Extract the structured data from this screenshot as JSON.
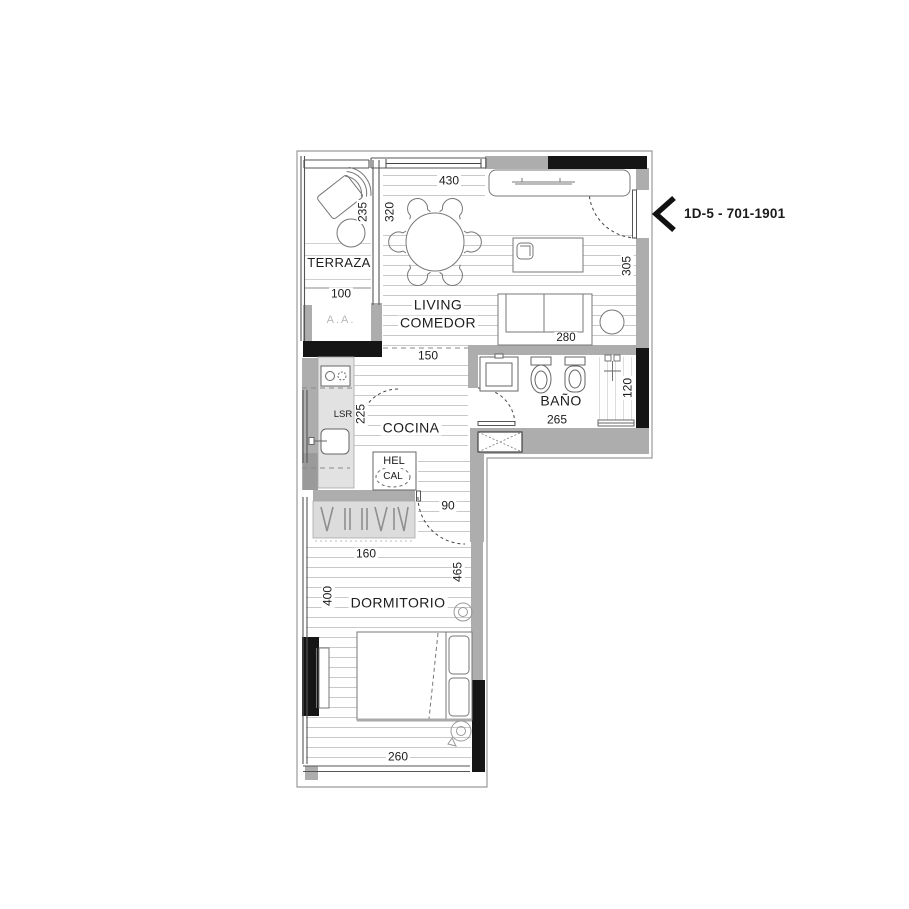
{
  "unit_label": {
    "text": "1D-5 - 701-1901"
  },
  "rooms": {
    "terraza": "TERRAZA",
    "living_line1": "LIVING",
    "living_line2": "COMEDOR",
    "cocina": "COCINA",
    "bano": "BAÑO",
    "dormitorio": "DORMITORIO"
  },
  "annotations": {
    "terraza_area": "100",
    "ac_unit": "A.A.",
    "washer": "LSR",
    "fridge": "HEL",
    "heater": "CAL"
  },
  "dimensions": {
    "living_window": "430",
    "living_width": "320",
    "terraza_length": "235",
    "living_length": "305",
    "sofa": "280",
    "kitchen_pass": "150",
    "cocina_length": "225",
    "bano_length": "265",
    "bano_width": "120",
    "dorm_door": "90",
    "dorm_closet": "160",
    "dorm_length": "465",
    "dorm_width": "400",
    "bed_wall": "260"
  },
  "colors": {
    "wall_gray": "#adadad",
    "wall_black": "#151515",
    "light_fill": "#e0e0e0",
    "furniture_line": "#777777",
    "floor_line": "#c9c9c9"
  }
}
